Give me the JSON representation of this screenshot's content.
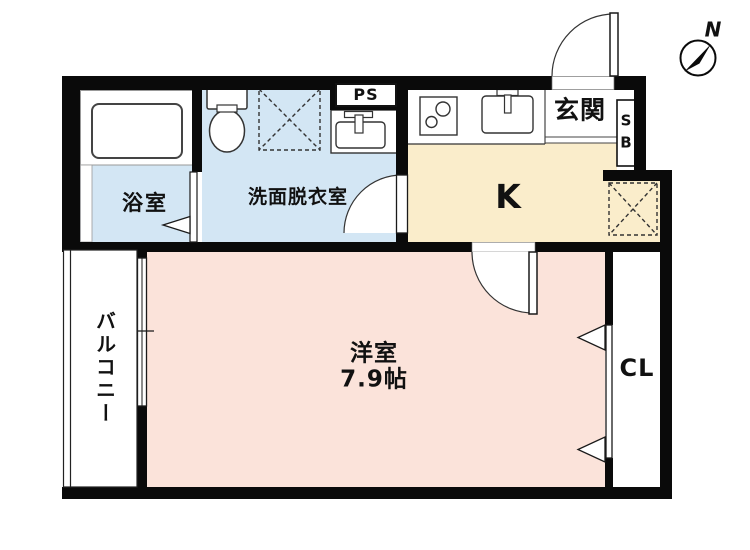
{
  "plan": {
    "type": "japanese-apartment-floorplan",
    "colors": {
      "wall": "#0a0a0a",
      "wet_area_fill": "#d3e6f4",
      "kitchen_fill": "#faedcb",
      "room_fill": "#fbe3da",
      "background": "#ffffff"
    }
  },
  "rooms": {
    "bathroom": {
      "label": "浴室"
    },
    "washroom": {
      "label": "洗面脱衣室"
    },
    "pipe_space": {
      "label": "PS"
    },
    "kitchen": {
      "label": "K"
    },
    "entrance": {
      "label": "玄関"
    },
    "shoe_box": {
      "label_top": "S",
      "label_bottom": "B"
    },
    "western_room": {
      "label": "洋室",
      "size": "7.9帖"
    },
    "closet": {
      "label": "CL"
    },
    "balcony": {
      "label": "バルコニー"
    }
  },
  "compass": {
    "label": "N"
  }
}
